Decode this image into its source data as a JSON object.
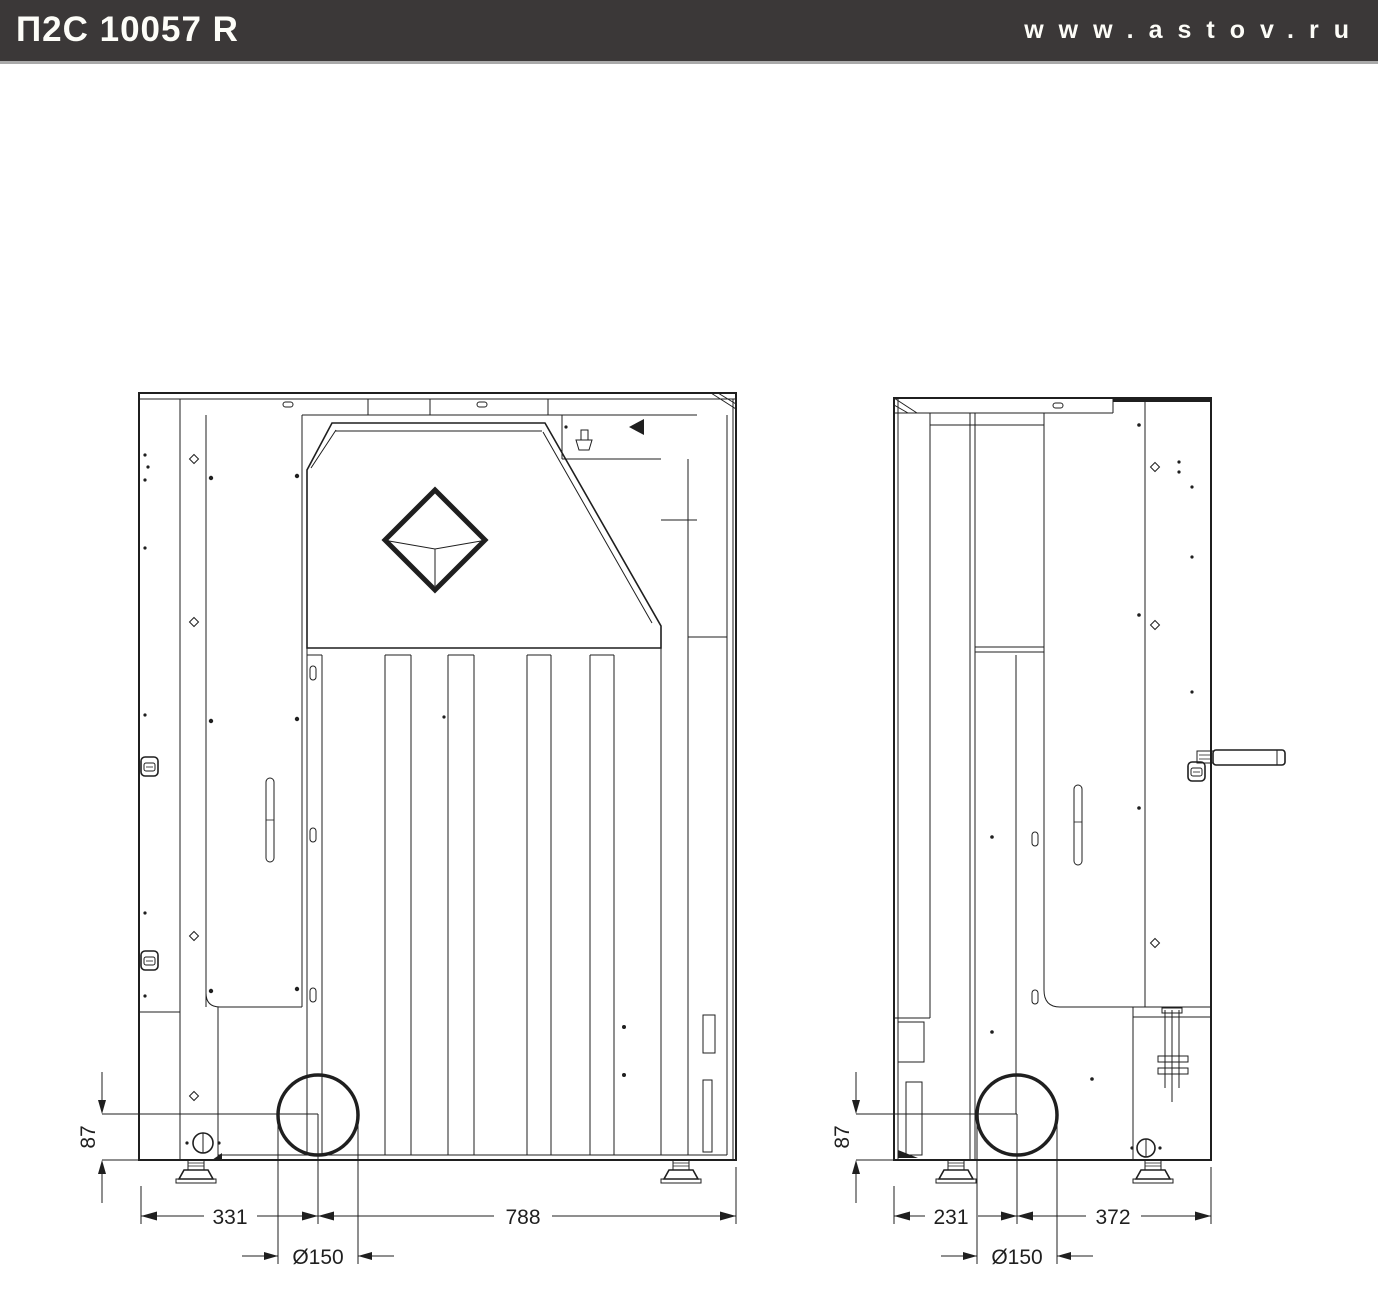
{
  "header": {
    "model": "П2С 10057 R",
    "website": "www.astov.ru"
  },
  "rear_view": {
    "dims": {
      "flue_height": "87",
      "left_to_flue_center": "331",
      "flue_center_to_right": "788",
      "flue_diameter": "Ø150"
    }
  },
  "side_view": {
    "dims": {
      "flue_height": "87",
      "left_to_flue_center": "231",
      "flue_center_to_right": "372",
      "flue_diameter": "Ø150"
    }
  }
}
